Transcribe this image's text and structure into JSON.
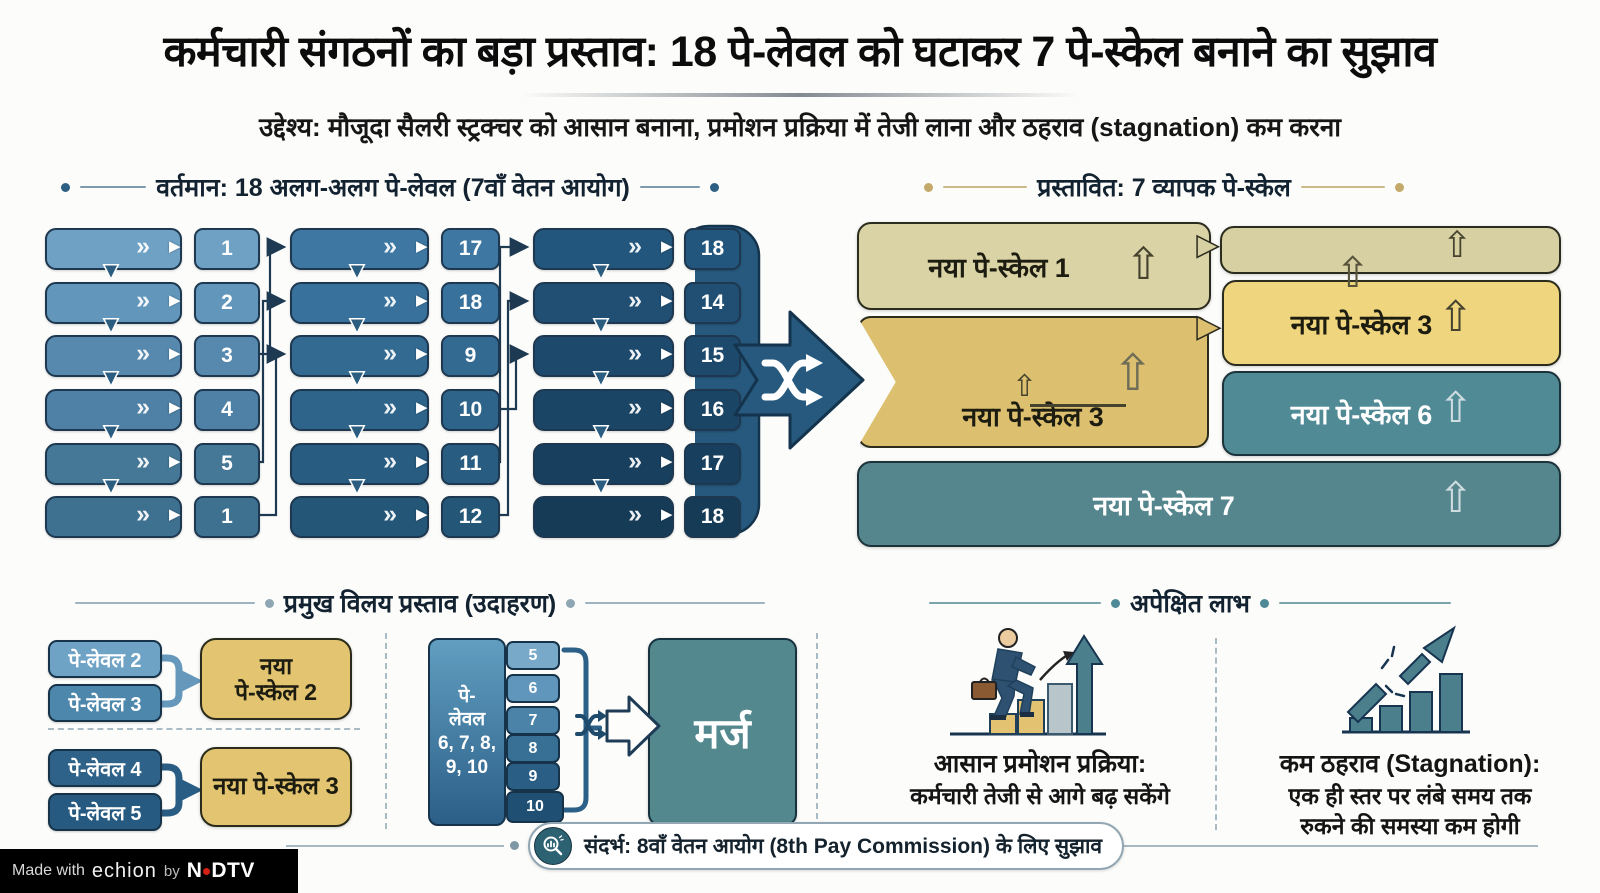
{
  "title": "कर्मचारी संगठनों का बड़ा प्रस्ताव: 18 पे-लेवल को घटाकर 7 पे-स्केल बनाने का सुझाव",
  "subtitle": "उद्देश्य: मौजूदा सैलरी स्ट्रक्चर को आसान बनाना, प्रमोशन प्रक्रिया में तेजी लाना और ठहराव (stagnation) कम करना",
  "current": {
    "heading": "वर्तमान: 18 अलग-अलग पे-लेवल (7वाँ वेतन आयोग)",
    "columns": [
      {
        "rows": [
          "1",
          "2",
          "3",
          "4",
          "5",
          "1"
        ]
      },
      {
        "rows": [
          "17",
          "18",
          "9",
          "10",
          "11",
          "12"
        ]
      },
      {
        "rows": [
          "18",
          "14",
          "15",
          "16",
          "17",
          "18"
        ]
      }
    ]
  },
  "proposed": {
    "heading": "प्रस्तावित: 7 व्यापक पे-स्केल",
    "scale1": "नया पे-स्केल 1",
    "scale3_right": "नया पे-स्केल 3",
    "scale3_left": "नया पे-स्केल 3",
    "scale6": "नया पे-स्केल 6",
    "scale7": "नया पे-स्केल 7"
  },
  "merge": {
    "heading": "प्रमुख विलय प्रस्ताव (उदाहरण)",
    "example1": {
      "sources": [
        "पे-लेवल 2",
        "पे-लेवल 3"
      ],
      "target_line1": "नया",
      "target_line2": "पे-स्केल 2"
    },
    "example2": {
      "sources": [
        "पे-लेवल 4",
        "पे-लेवल 5"
      ],
      "target": "नया पे-स्केल 3"
    },
    "example3": {
      "label_lines": [
        "पे-",
        "लेवल",
        "6, 7, 8,",
        "9, 10"
      ],
      "chips": [
        "5",
        "6",
        "7",
        "8",
        "9",
        "10"
      ],
      "target": "मर्ज"
    }
  },
  "benefits": {
    "heading": "अपेक्षित लाभ",
    "items": [
      {
        "title": "आसान प्रमोशन प्रक्रिया:",
        "line1": "कर्मचारी तेजी से आगे बढ़ सकेंगे",
        "line2": ""
      },
      {
        "title": "कम ठहराव (Stagnation):",
        "line1": "एक ही स्तर पर लंबे समय तक",
        "line2": "रुकने की समस्या कम होगी"
      }
    ]
  },
  "footer": {
    "reference": "संदर्भ: 8वाँ वेतन आयोग (8th Pay Commission) के लिए सुझाव"
  },
  "credit": {
    "made_with": "Made with",
    "tool": "echion",
    "by": "by",
    "brand_n": "N",
    "brand_rest": "DTV"
  },
  "icons": {
    "chevron": "»",
    "flow_arrow": "▶",
    "down_arrow": "▼",
    "up_arrow": "⇧"
  },
  "colors": {
    "current_blue_light": "#6fa1c4",
    "current_blue_dark": "#163b57",
    "flow_arrow_blue": "#26597d",
    "khaki": "#d9d3a6",
    "gold": "#ddc06f",
    "yellow": "#efd57e",
    "teal": "#4f8a95",
    "teal_dark": "#55868e",
    "accent_dot_gold": "#c3a96a",
    "credit_red": "#d42015"
  }
}
